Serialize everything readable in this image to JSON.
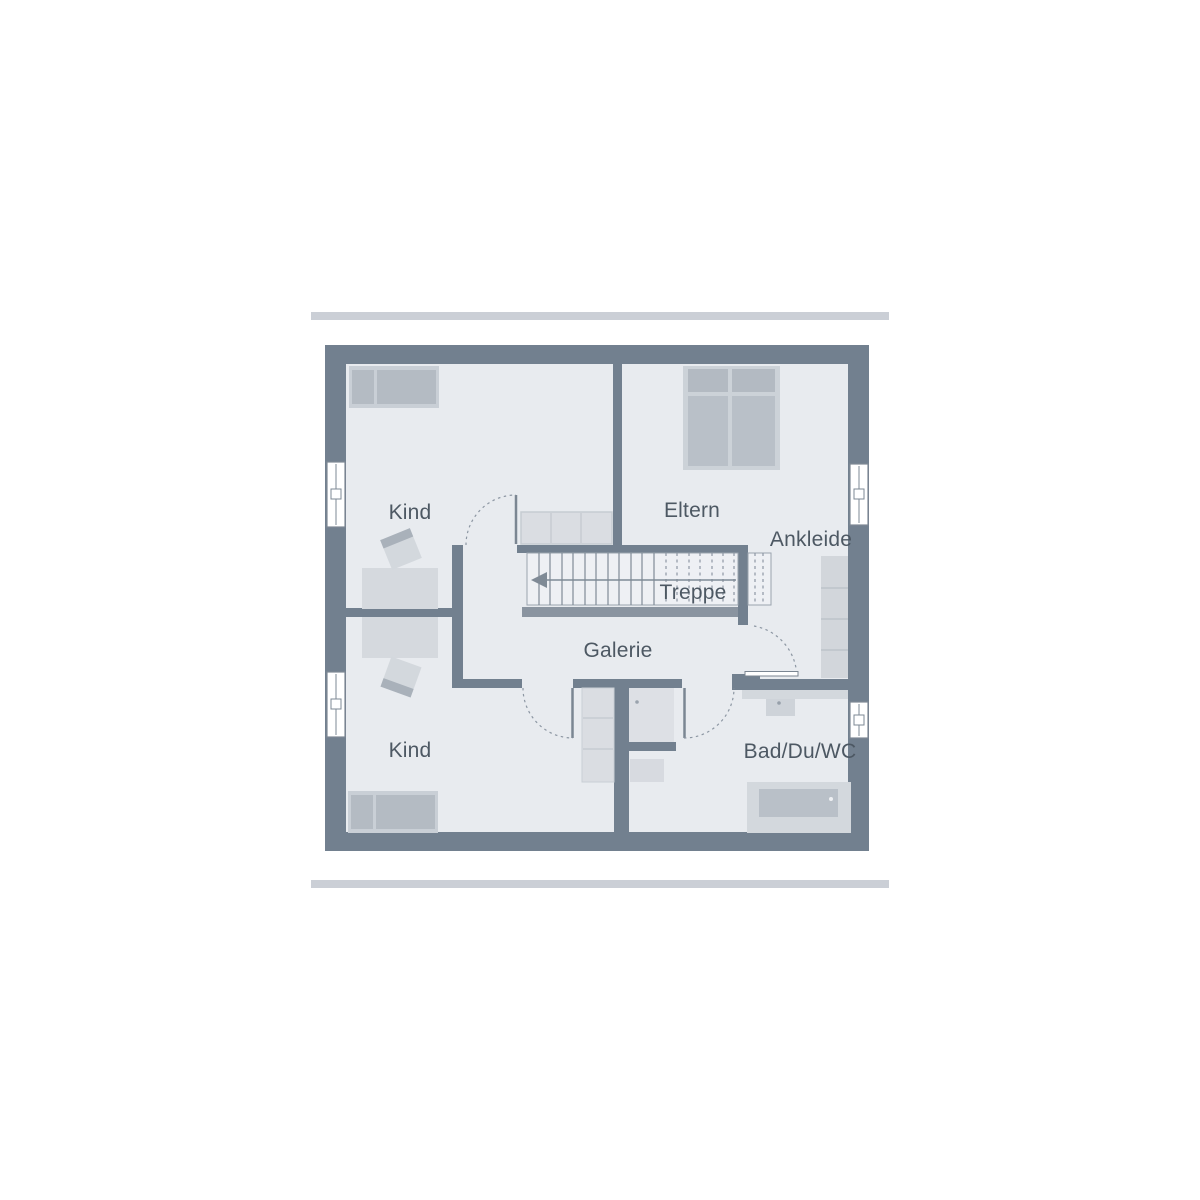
{
  "plan": {
    "title": "floor-plan-upper-storey",
    "labels": {
      "kind_top": "Kind",
      "kind_bottom": "Kind",
      "eltern": "Eltern",
      "ankleide": "Ankleide",
      "treppe": "Treppe",
      "galerie": "Galerie",
      "bad": "Bad/Du/WC"
    },
    "colors": {
      "wall": "#72808F",
      "floor": "#e8ebef",
      "stair_fill": "#eef0f4",
      "furniture_dark": "#b4bbc3",
      "furniture_frame": "#ccd2d8",
      "cabinet_fill": "#dadde2",
      "counter_fill": "#d3d8dd",
      "tub_fill": "#b9c0c8",
      "shower_fill": "#dde0e5",
      "line": "#7b8692",
      "dash": "#8d97a3",
      "accent_bar": "#cbcfd6",
      "label_text": "#4d5863"
    }
  }
}
